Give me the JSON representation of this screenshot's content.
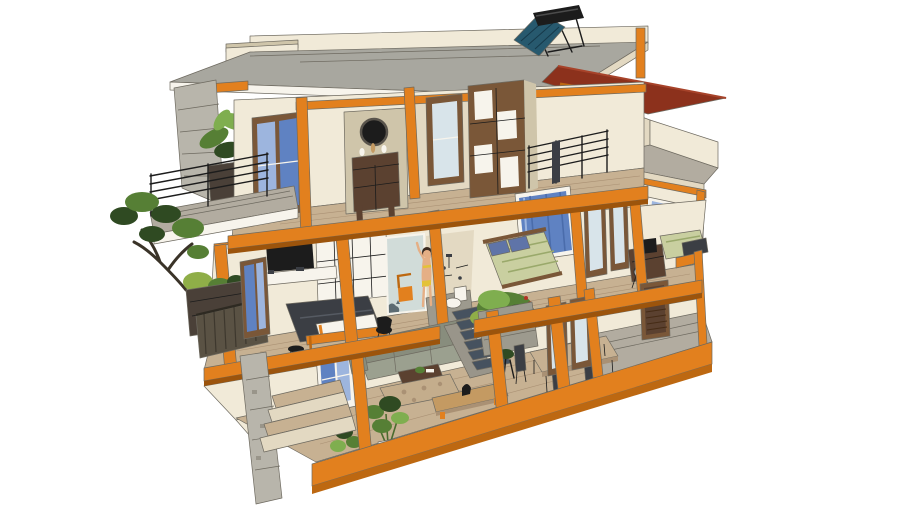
{
  "meta": {
    "title": "Three-storey house 3D cutaway section"
  },
  "scene": {
    "description": "3D dollhouse-style cutaway of a three-storey house with an orange post-and-beam frame: rooftop solar water heater and red awning over a roof terrace, top-floor altar room with wardrobe and balcony palm, middle-floor master bedroom with TV and bed, bathroom with showering figure, two more bedrooms and a desk, bonsai tree on a planter balcony, and a ground floor with sofa, staircase with shrub planter, dining table, potted plants, porch and a concrete pillar with entry steps.",
    "objects": [
      {
        "id": "solar-water-heater",
        "label": "Solar water heater on roof"
      },
      {
        "id": "flat-roof",
        "label": "Concrete flat roof with cream parapet"
      },
      {
        "id": "awning",
        "label": "Dark red awning over roof terrace"
      },
      {
        "id": "roof-terrace",
        "label": "Roof terrace with parapet walls"
      },
      {
        "id": "prayer-room",
        "label": "Top floor altar room with wooden altar cabinet and round mirror"
      },
      {
        "id": "wardrobe",
        "label": "Top floor shelving wardrobe"
      },
      {
        "id": "stair-railing",
        "label": "Black metal stair railing"
      },
      {
        "id": "top-balcony",
        "label": "Top floor balcony with palm planter"
      },
      {
        "id": "master-bedroom",
        "label": "Master bedroom with wall TV, console and double bed"
      },
      {
        "id": "bathroom",
        "label": "Bathroom with glass partition, showering figure and toilet"
      },
      {
        "id": "second-bedroom",
        "label": "Bedroom with green bed and blue curtain window"
      },
      {
        "id": "study",
        "label": "Desk with monitor and chair"
      },
      {
        "id": "third-bedroom",
        "label": "Right bedroom with single bed and window"
      },
      {
        "id": "balcony-bonsai",
        "label": "Bonsai tree on middle balcony planter"
      },
      {
        "id": "living-room",
        "label": "Living room with sofa, coffee table and rug"
      },
      {
        "id": "staircase",
        "label": "Dark stone staircase with shrub planter"
      },
      {
        "id": "dining-area",
        "label": "Dining table with dark chairs"
      },
      {
        "id": "houseplants",
        "label": "Potted fiddle-leaf plants"
      },
      {
        "id": "porch",
        "label": "Ground floor porch with louvered door"
      },
      {
        "id": "concrete-pillar",
        "label": "Concrete pillar under left balcony"
      },
      {
        "id": "entry-steps",
        "label": "Front entry steps"
      },
      {
        "id": "structural-frame",
        "label": "Orange post-and-beam structural frame"
      }
    ]
  },
  "palette": {
    "orange": "#E2801E",
    "orangeDark": "#BD6811",
    "orangeDeep": "#9C540C",
    "cream": "#F1EAD8",
    "creamShadow": "#E3D9C2",
    "creamDark": "#CFC5AA",
    "white": "#F7F4EC",
    "roofGray": "#A8A79F",
    "roofGrayDark": "#908F88",
    "concrete": "#B8B5AB",
    "concreteDark": "#99958A",
    "awning": "#8C311C",
    "awningLight": "#A7432A",
    "glassBlue": "#5F82C2",
    "glassBlueLight": "#9DB5DE",
    "glassPale": "#D8E4EA",
    "tealPanel": "#27596E",
    "woodFloor": "#C7B192",
    "woodFloorDark": "#AA9174",
    "woodDark": "#5B4130",
    "woodMid": "#7A5738",
    "woodLight": "#C49A62",
    "black": "#1C1C1C",
    "charcoal": "#3B3E44",
    "sofa": "#888D7D",
    "sofaLight": "#9BA08F",
    "green": "#567F35",
    "greenDark": "#2F4A22",
    "greenLight": "#7FAE4F",
    "greenYellow": "#8FAE48",
    "bedding": "#C9CFA0",
    "pillowBlue": "#5F74A8",
    "skin": "#E5AF85",
    "bikini": "#E3C238",
    "hair": "#3A2A20",
    "stair": "#46525F",
    "rug": "#C4AD8C",
    "grayFloor": "#B2ACA0",
    "slat": "#5A5244",
    "slatDark": "#3E382E",
    "stone": "#9D9A8E",
    "edge": "#6E6A60",
    "red": "#B03326",
    "planterDark": "#4A4038"
  }
}
